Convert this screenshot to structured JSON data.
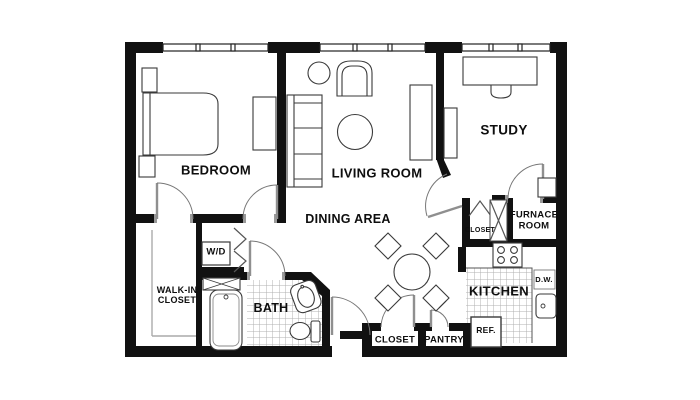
{
  "floor_plan": {
    "labels": {
      "bedroom": "BEDROOM",
      "living_room": "LIVING ROOM",
      "study": "STUDY",
      "dining_area": "DINING AREA",
      "walk_in_closet": "WALK-IN\nCLOSET",
      "washer_dryer": "W/D",
      "bath": "BATH",
      "kitchen": "KITCHEN",
      "furnace_room": "FURNACE\nROOM",
      "hall_closet": "CLOSET",
      "entry_closet": "CLOSET",
      "pantry": "PANTRY",
      "dishwasher": "D.W.",
      "refrigerator": "REF."
    },
    "colors": {
      "wall": "#111111",
      "furniture_line": "#3a3a3a",
      "door_gray": "#8f8f8f",
      "tile_line": "#b0b0b0",
      "background": "#ffffff",
      "text": "#0e0e0e"
    }
  }
}
